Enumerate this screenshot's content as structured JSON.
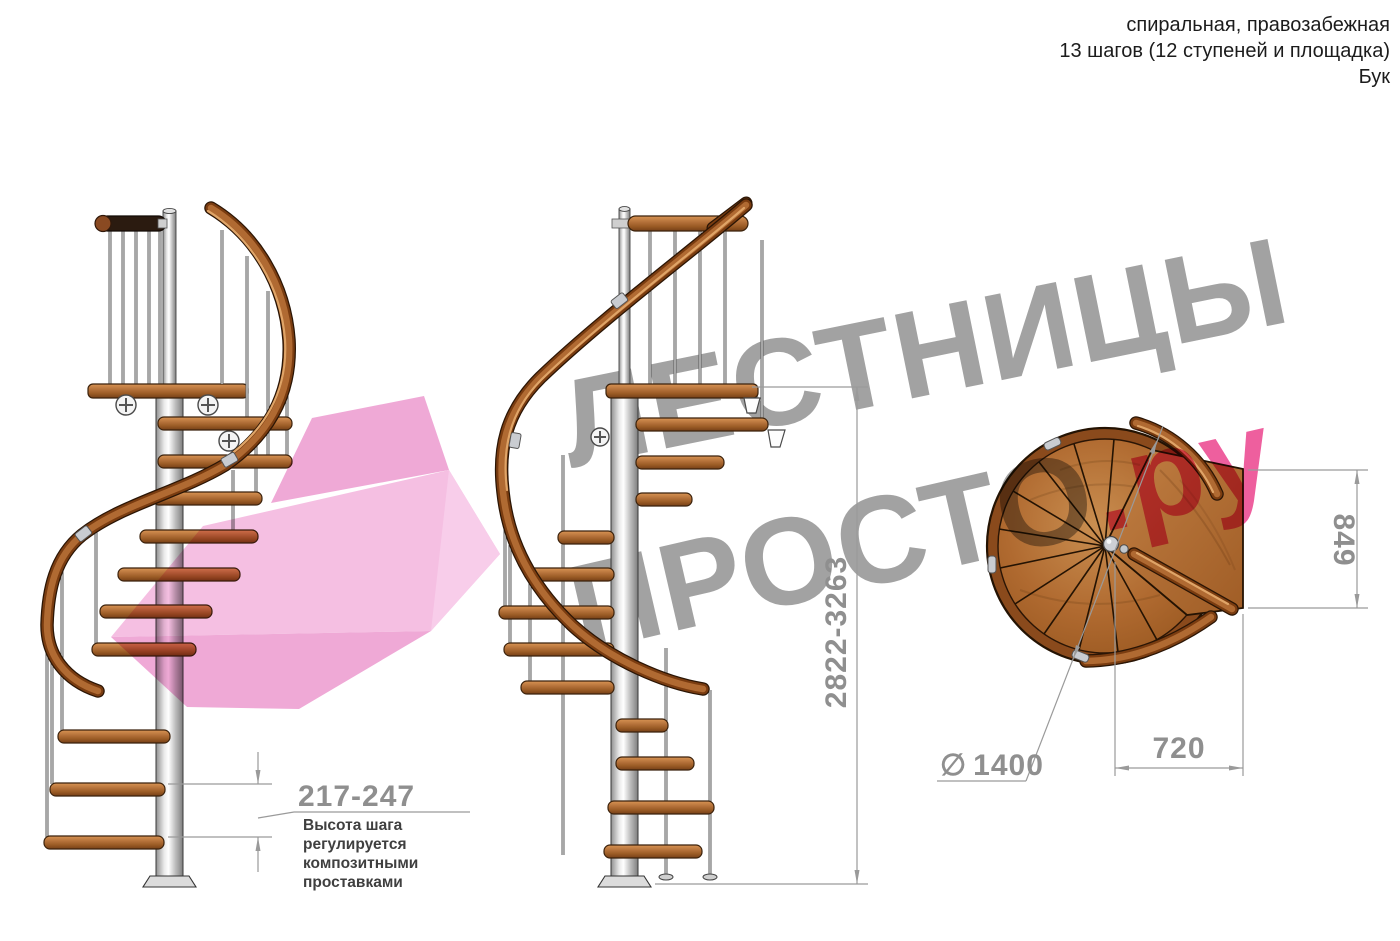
{
  "header": {
    "line1": "спиральная, правозабежная",
    "line2": "13 шагов (12 ступеней и площадка)",
    "line3": "Бук"
  },
  "watermark": {
    "word1": "ЛЕСТНИЦЫ",
    "word2": "ПРОСТО",
    "word2_suffix": ".ру"
  },
  "dimensions": {
    "height_range": "2822-3263",
    "platform_depth": "849",
    "platform_width": "720",
    "diameter_symbol": "∅",
    "diameter_value": "1400",
    "step_height_range": "217-247"
  },
  "note": {
    "line1": "Высота шага",
    "line2": "регулируется",
    "line3": "композитными",
    "line4": "проставками"
  },
  "colors": {
    "wm_gray": "#a2a2a2",
    "wm_pink": "#ee5f9e",
    "arrow_pink_light": "#f5bfe2",
    "arrow_pink_mid": "#efa9d6",
    "wood_mid": "#b06a32",
    "dim_gray": "#9a9a9a",
    "note_dark": "#3f3f3f",
    "header_dark": "#1c1c1c"
  }
}
